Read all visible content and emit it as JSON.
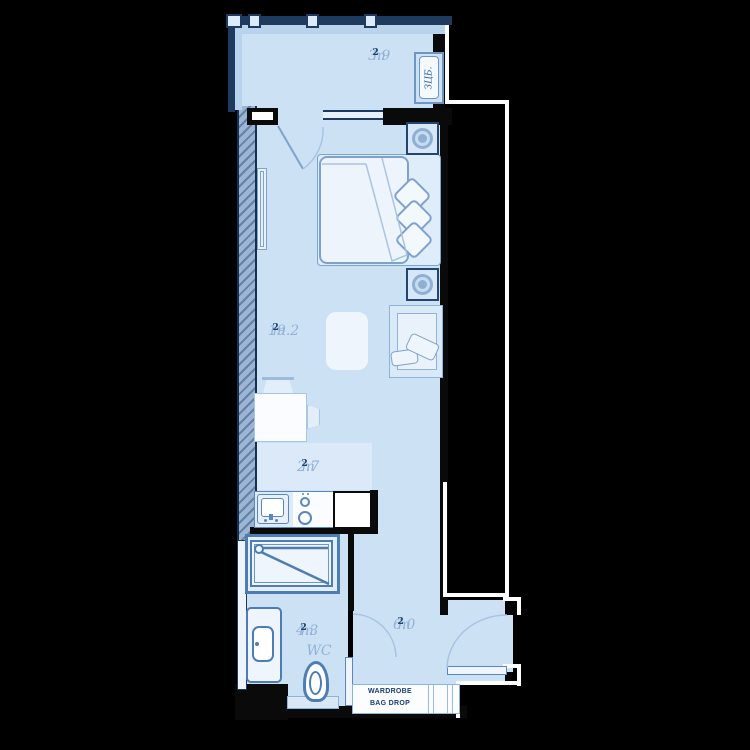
{
  "plan": {
    "balcony": {
      "area_value": "3.9",
      "area_unit": "m",
      "area_sup": "2",
      "box_label": "ЗЦБ."
    },
    "room": {
      "area_value": "19.2",
      "area_unit": "m",
      "area_sup": "2"
    },
    "kitchen": {
      "area_value": "2.7",
      "area_unit": "m",
      "area_sup": "2"
    },
    "bathroom": {
      "area_value": "4.3",
      "area_unit": "m",
      "area_sup": "2",
      "wc_label": "WC"
    },
    "hallway": {
      "area_value": "6.0",
      "area_unit": "m",
      "area_sup": "2"
    },
    "wardrobe": {
      "line1": "WARDROBE",
      "line2": "BAG DROP"
    },
    "colors": {
      "background": "#000000",
      "interior": "#cde1f5",
      "kitchen_zone": "#dce9f8",
      "wall": "#0a0a0a",
      "outline": "#ffffff",
      "fixture_stroke": "#4d7db2",
      "furniture_stroke": "#7da3cc",
      "label_text": "#93b1d6",
      "label_sup": "#1d4368",
      "glazing_line": "#1e3a5f"
    }
  }
}
